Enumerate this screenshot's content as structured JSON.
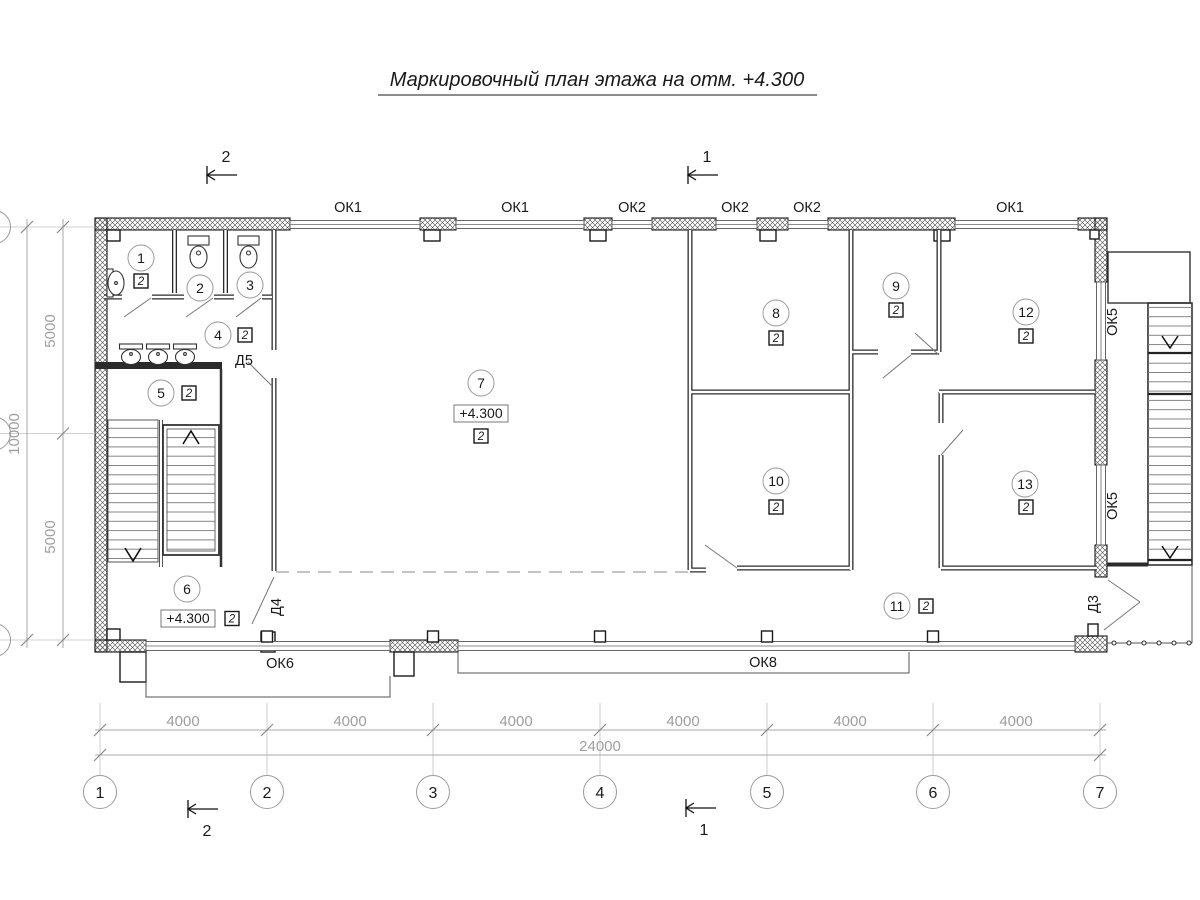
{
  "title": "Маркировочный план этажа на отм. +4.300",
  "sections": {
    "mark1": "1",
    "mark2": "2"
  },
  "rooms": [
    {
      "number": "1",
      "mark": "2"
    },
    {
      "number": "2"
    },
    {
      "number": "3"
    },
    {
      "number": "4",
      "mark": "2"
    },
    {
      "number": "5",
      "mark": "2"
    },
    {
      "number": "6",
      "mark": "2",
      "elevation": "+4.300"
    },
    {
      "number": "7",
      "mark": "2",
      "elevation": "+4.300"
    },
    {
      "number": "8",
      "mark": "2"
    },
    {
      "number": "9",
      "mark": "2"
    },
    {
      "number": "10",
      "mark": "2"
    },
    {
      "number": "11",
      "mark": "2"
    },
    {
      "number": "12",
      "mark": "2"
    },
    {
      "number": "13",
      "mark": "2"
    }
  ],
  "windows": {
    "top": [
      "ОК1",
      "ОК1",
      "ОК2",
      "ОК2",
      "ОК2",
      "ОК1"
    ],
    "right": [
      "ОК5",
      "ОК5"
    ],
    "bottom": [
      "ОК6",
      "ОК8"
    ]
  },
  "doors": {
    "d3": "Д3",
    "d4": "Д4",
    "d5": "Д5"
  },
  "axes": {
    "bottom": [
      "1",
      "2",
      "3",
      "4",
      "5",
      "6",
      "7"
    ]
  },
  "dimensions": {
    "bottom_segments": [
      "4000",
      "4000",
      "4000",
      "4000",
      "4000",
      "4000"
    ],
    "bottom_total": "24000",
    "left_top": "5000",
    "left_bottom": "5000",
    "left_total": "10000"
  }
}
